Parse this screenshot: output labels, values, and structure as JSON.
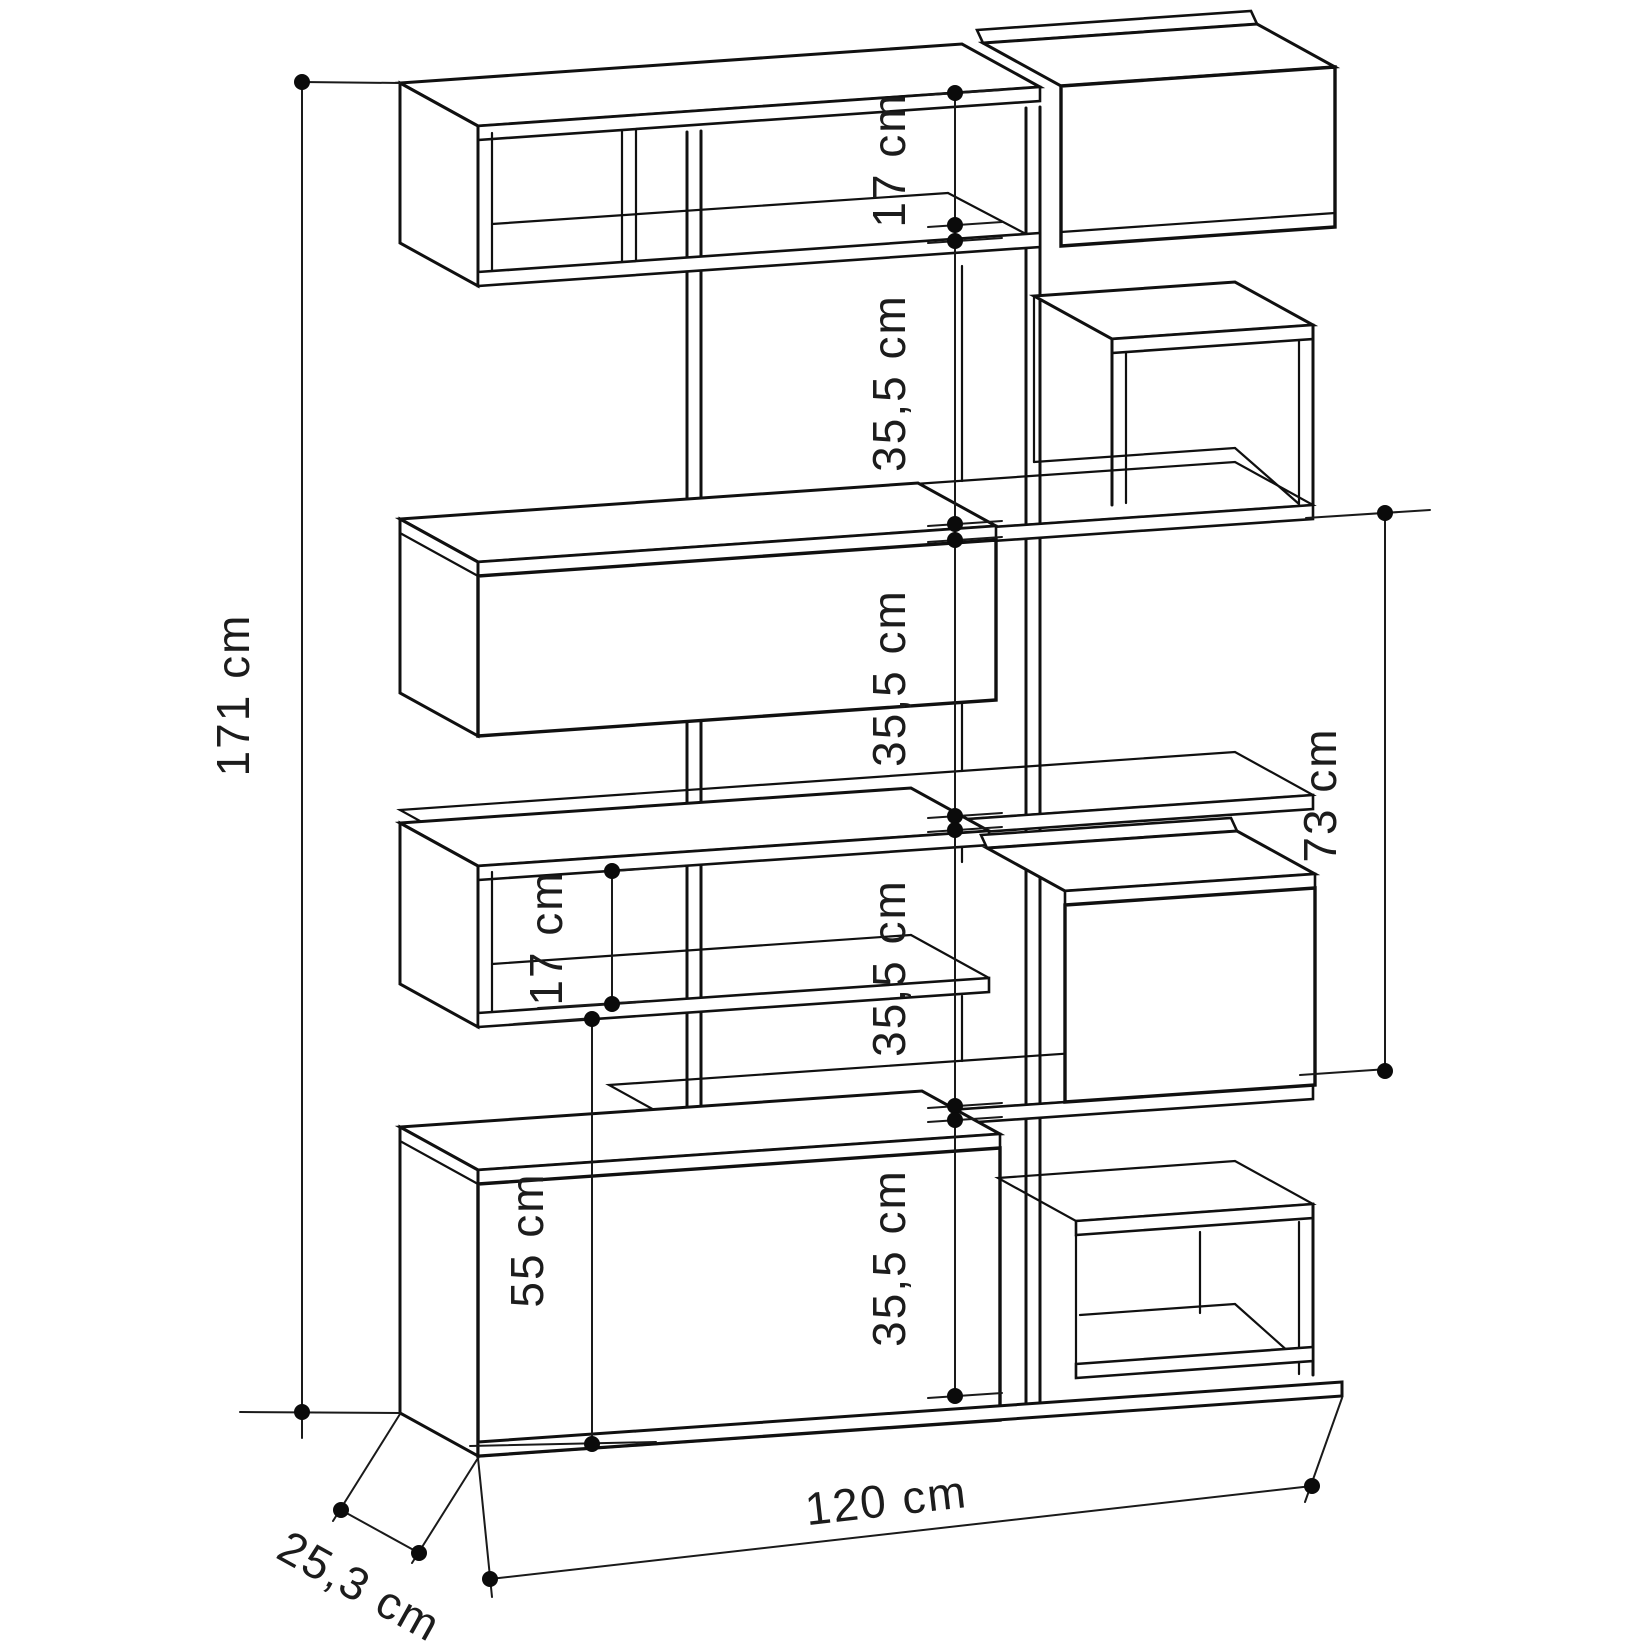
{
  "page": {
    "background": "#ffffff",
    "ink": "#101010"
  },
  "drawing": {
    "type": "furniture-dimension-diagram",
    "subject": "staggered bookcase / shelving unit, perspective line drawing with dimension lines",
    "units": "cm",
    "labels": {
      "overall_height": "171 cm",
      "overall_width": "120 cm",
      "overall_depth": "25,3 cm",
      "right_column_height": "73 cm",
      "left_lower_height": "55 cm",
      "left_box_inner_height": "17 cm",
      "top_inner_height": "17 cm",
      "bay_heights": [
        "35,5 cm",
        "35,5 cm",
        "35,5 cm",
        "35,5 cm"
      ]
    }
  }
}
